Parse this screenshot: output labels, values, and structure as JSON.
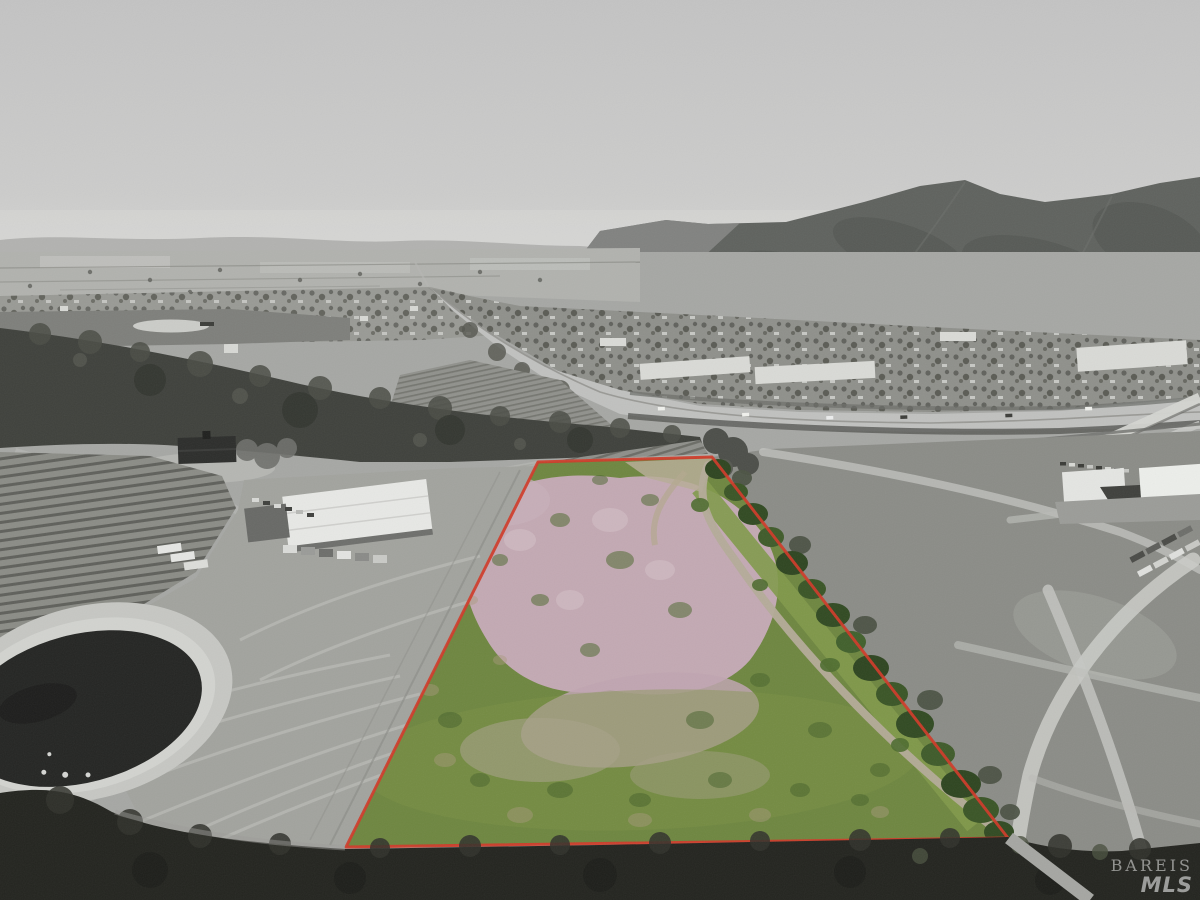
{
  "watermark": {
    "line1": "BAREIS",
    "line2": "MLS",
    "color": "#ffffff"
  },
  "parcel": {
    "outline_points": "538,462 712,457 1008,838 346,847",
    "outline_color": "#d03a28",
    "field_green": "#6e8640",
    "bloom_pink": "#c3a9b3",
    "tree_green": "#3b5628",
    "road_tan": "#b4ab99"
  },
  "palette": {
    "sky_top": "#c3c3c3",
    "sky_horizon": "#d2d2d0",
    "mountain": "#5f625e",
    "far_ridge": "#b2b2b0",
    "valley": "#a6a7a4",
    "highway": "#c0c1bf",
    "forest": "#3f413c",
    "pond_water": "#242523",
    "plowed_field": "#a2a39e",
    "roof_white": "#e7e8e5",
    "bottom_brush": "#23241f"
  }
}
